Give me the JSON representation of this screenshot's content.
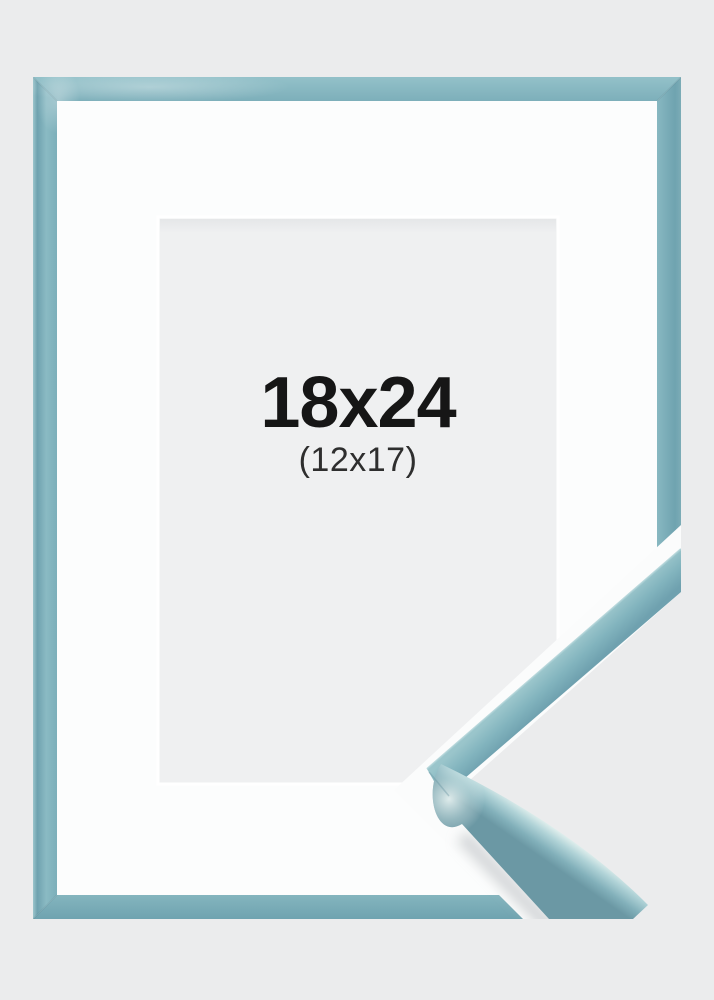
{
  "product_image": {
    "size_label": {
      "primary": "18x24",
      "secondary": "(12x17)"
    },
    "colors": {
      "background": "#ebeced",
      "frame": "#7fb2bc",
      "frame_dark_edge": "#68949f",
      "frame_gloss_highlight": "#e9f4f1",
      "mat": "#fcfdfd",
      "opening": "#eff0f1",
      "text_primary": "#161616",
      "text_secondary": "#2e2e2e"
    }
  }
}
